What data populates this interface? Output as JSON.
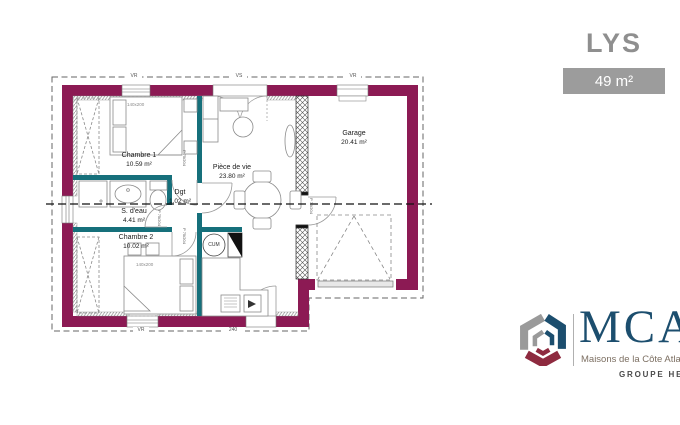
{
  "header": {
    "model_name": "LYS",
    "area_badge": "49 m²"
  },
  "plan": {
    "rooms": {
      "chambre1": {
        "name": "Chambre 1",
        "area": "10.59 m²"
      },
      "sdeau": {
        "name": "S. d'eau",
        "area": "4.41 m²"
      },
      "chambre2": {
        "name": "Chambre 2",
        "area": "10.02 m²"
      },
      "dgt": {
        "name": "Dgt",
        "area": "1.02 m²"
      },
      "piece_de_vie": {
        "name": "Pièce de vie",
        "area": "23.80 m²"
      },
      "garage": {
        "name": "Garage",
        "area": "20.41 m²"
      }
    },
    "annotations": {
      "door_label": "P 75/204",
      "bed_size": "140x200",
      "water_heater": "CUM",
      "window_top_left": "VR",
      "window_top_center": "VS",
      "window_top_right": "VR",
      "window_bottom_left": "VR",
      "dim_bottom": "240"
    },
    "colors": {
      "exterior_wall": "#8c1a54",
      "interior_wall": "#16707b"
    }
  },
  "branding": {
    "logo_text": "MCA",
    "logo_subtitle": "Maisons de la Côte Atlantique",
    "group_label": "GROUPE HEXAOM",
    "colors": {
      "logo_blue": "#1c4e6e",
      "logo_gray": "#9a9a9a",
      "logo_maroon": "#8e2a3f"
    }
  }
}
